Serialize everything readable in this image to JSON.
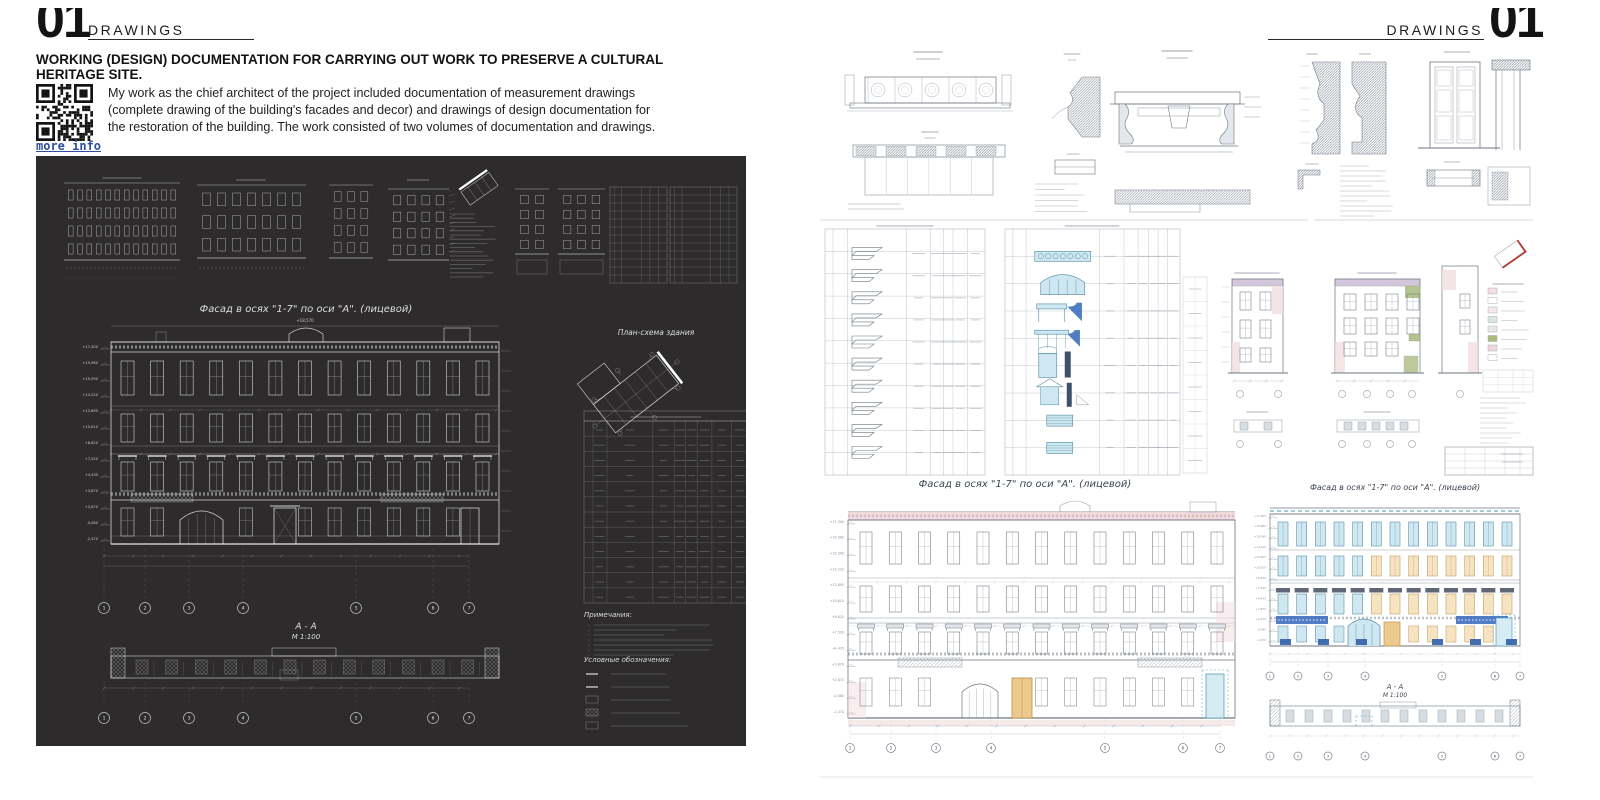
{
  "left_page": {
    "page_number": "01",
    "section_label": "DRAWINGS",
    "title": "WORKING (DESIGN) DOCUMENTATION FOR CARRYING OUT WORK TO PRESERVE A CULTURAL HERITAGE SITE.",
    "qr_link_label": "more info",
    "description": "My work as the chief architect of the project included documentation of measurement drawings (complete drawing of the building's facades and decor) and drawings of design documentation for the restoration of the building. The work consisted of two volumes of documentation and drawings.",
    "dark_sheet": {
      "facade_caption": "Фасад  в осях  \"1-7\"  по оси  \"А\". (лицевой)",
      "plan_caption": "План-схема здания",
      "section_caption": "А - А",
      "section_scale": "М 1:100",
      "notes_title": "Примечания:",
      "legend_title": "Условные обозначения:",
      "top_elevation": "+18,570",
      "axis_labels": [
        "1",
        "2",
        "3",
        "4",
        "5",
        "6",
        "7"
      ],
      "elevation_marks": [
        "+17,300",
        "+15,980",
        "+15,090",
        "+14,220",
        "+12,895",
        "+10,610",
        "+8,620",
        "+7,520",
        "+4,435",
        "+3,870",
        "+2,670",
        "-0,080",
        "-2,470"
      ]
    }
  },
  "right_page": {
    "page_number": "01",
    "section_label": "DRAWINGS",
    "sheet": {
      "measured_facade_caption": "Фасад  в осях  \"1-7\"  по оси  \"А\". (лицевой)",
      "colored_facade_caption": "Фасад  в осях  \"1-7\"  по оси  \"А\". (лицевой)",
      "section_caption": "А - А",
      "section_scale": "М 1:100",
      "axis_labels": [
        "1",
        "2",
        "3",
        "4",
        "5",
        "6",
        "7"
      ]
    }
  },
  "colors": {
    "link_blue": "#2d4f9e",
    "sheet_dark_bg": "#2d2b2b",
    "drawing_white": "#e8e8e8",
    "drawing_gray": "#8f98a3",
    "drawing_dark_gray": "#6d7680",
    "window_blue_fill": "#cfe7f0",
    "window_blue_stroke": "#4d8ba3",
    "window_tan_fill": "#f6e3c2",
    "window_tan_stroke": "#c49a55",
    "hood_slate": "#55616e",
    "railing_blue": "#3f6fc1",
    "plinth_navy": "#2f5fa8",
    "band_pink": "#eed7d9",
    "band_lavender": "#cfc3d8",
    "accent_green": "#a8b87a",
    "keyplan_red": "#b03a2e",
    "door_tan": "#ecca8e"
  }
}
